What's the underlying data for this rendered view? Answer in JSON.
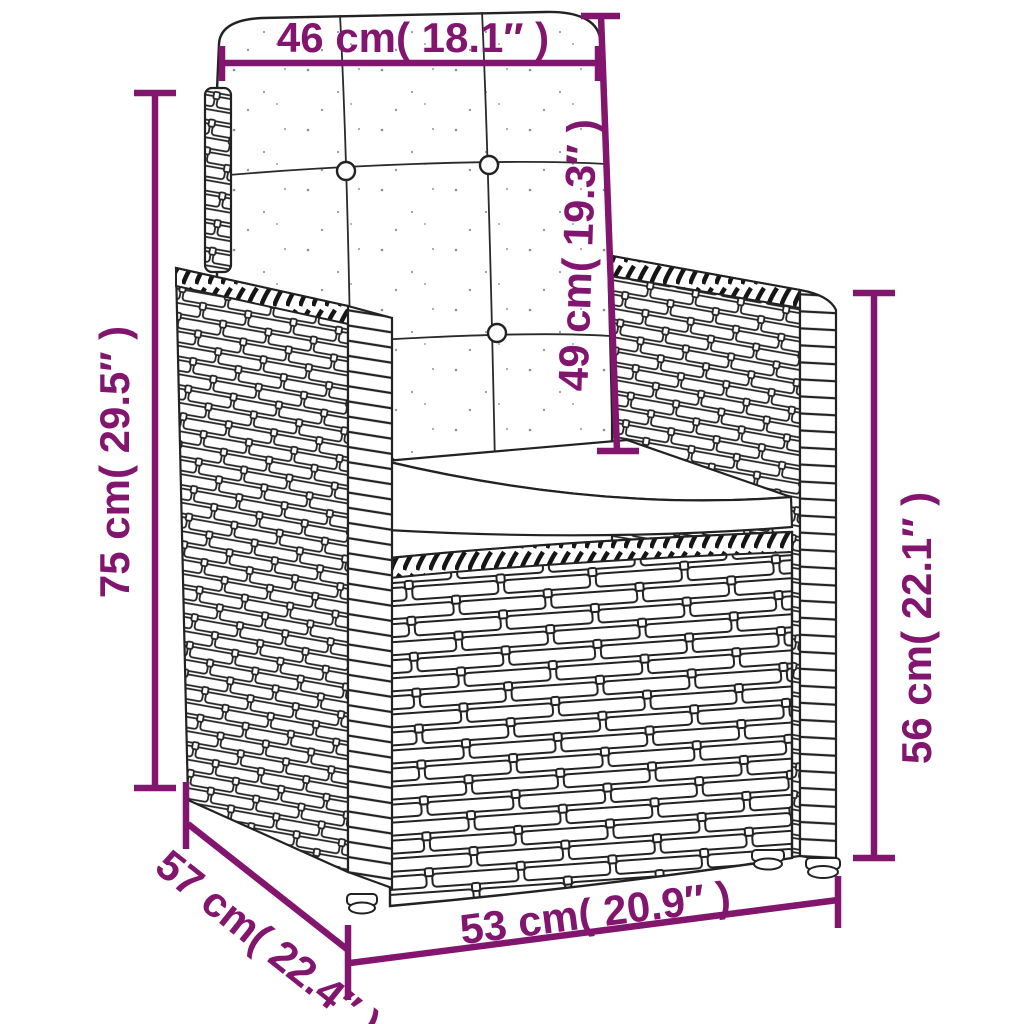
{
  "figure": {
    "kind": "product-dimension-line-drawing",
    "subject": "rattan-wicker-armchair-with-back-and-seat-cushions"
  },
  "colors": {
    "dimension_annotation": "#82156E",
    "artwork_line": "#222222",
    "background": "#FFFFFF"
  },
  "dimensions": {
    "back_width": {
      "label": "46 cm( 18.1″ )"
    },
    "back_cushion_height": {
      "label": "49 cm( 19.3″ )"
    },
    "overall_height": {
      "label": "75 cm( 29.5″ )"
    },
    "armrest_height": {
      "label": "56 cm( 22.1″ )"
    },
    "depth": {
      "label": "57 cm( 22.4″ )"
    },
    "front_width": {
      "label": "53 cm( 20.9″ )"
    }
  }
}
